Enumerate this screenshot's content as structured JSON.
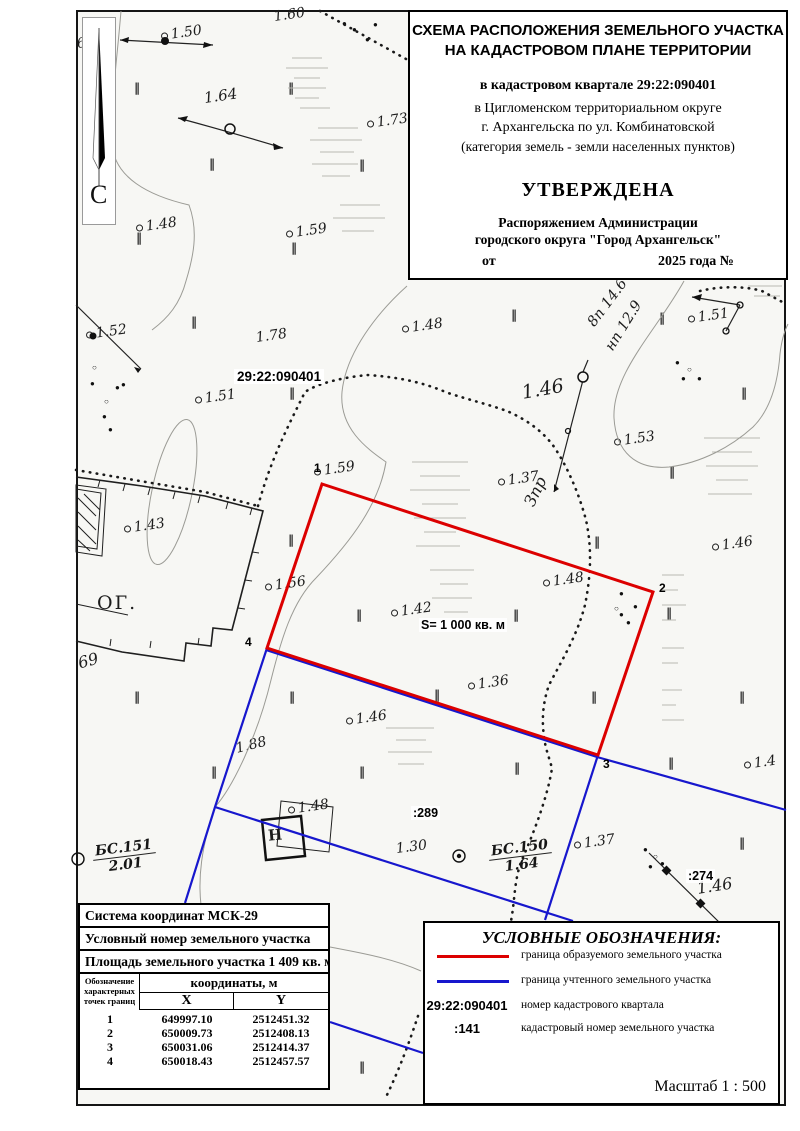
{
  "title_block": {
    "line1": "СХЕМА РАСПОЛОЖЕНИЯ ЗЕМЕЛЬНОГО УЧАСТКА",
    "line2": "НА КАДАСТРОВОМ ПЛАНЕ ТЕРРИТОРИИ",
    "quarter": "в кадастровом квартале 29:22:090401",
    "district1": "в Цигломенском территориальном округе",
    "district2": "г. Архангельска по ул. Комбинатовской",
    "category": "(категория земель - земли населенных пунктов)",
    "approved": "УТВЕРЖДЕНА",
    "order1": "Распоряжением Администрации",
    "order2": "городского округа \"Город Архангельск\"",
    "date_from": "от",
    "date_year": "2025 года №"
  },
  "north_label": "С",
  "map": {
    "quarter_label": "29:22:090401",
    "area_label": "S= 1 000 кв. м",
    "parcel_289": ":289",
    "parcel_274": ":274",
    "og_label": "ОГ.",
    "label_69": "69",
    "zpr_label": "Зпр",
    "line8p": "8п 14.6",
    "line_np": "нп 12.9",
    "bs150_top": "БС.150",
    "bs150_bottom": "1.64",
    "bs151_top": "БС.151",
    "bs151_bottom": "2.01",
    "building_label": "Н",
    "point_labels": [
      {
        "n": "1",
        "x": 314,
        "y": 461
      },
      {
        "n": "2",
        "x": 659,
        "y": 581
      },
      {
        "n": "3",
        "x": 603,
        "y": 757
      },
      {
        "n": "4",
        "x": 245,
        "y": 635
      }
    ],
    "red_parcel": [
      [
        322,
        484
      ],
      [
        653,
        592
      ],
      [
        598,
        755
      ],
      [
        267,
        648
      ]
    ],
    "blue_lines": [
      [
        [
          266,
          650
        ],
        [
          597,
          757
        ],
        [
          786,
          810
        ]
      ],
      [
        [
          267,
          648
        ],
        [
          215,
          807
        ],
        [
          185,
          903
        ]
      ],
      [
        [
          215,
          807
        ],
        [
          573,
          921
        ]
      ],
      [
        [
          598,
          755
        ],
        [
          545,
          920
        ]
      ],
      [
        [
          330,
          1022
        ],
        [
          423,
          1053
        ]
      ]
    ],
    "elevations": [
      {
        "t": "6",
        "x": 77,
        "y": 36,
        "c": false
      },
      {
        "t": "1.50",
        "x": 161,
        "y": 28,
        "c": true
      },
      {
        "t": "1.60",
        "x": 274,
        "y": 9,
        "c": false
      },
      {
        "t": "1.64",
        "x": 204,
        "y": 89,
        "c": false,
        "s": 15
      },
      {
        "t": "1.73",
        "x": 367,
        "y": 116,
        "c": true
      },
      {
        "t": "1.48",
        "x": 136,
        "y": 220,
        "c": true
      },
      {
        "t": "1.59",
        "x": 286,
        "y": 226,
        "c": true
      },
      {
        "t": "1.52",
        "x": 86,
        "y": 327,
        "c": true
      },
      {
        "t": "1.78",
        "x": 256,
        "y": 330,
        "c": false
      },
      {
        "t": "1.51",
        "x": 195,
        "y": 392,
        "c": true
      },
      {
        "t": "1.48",
        "x": 402,
        "y": 321,
        "c": true
      },
      {
        "t": "1.46",
        "x": 522,
        "y": 382,
        "c": false,
        "s": 19,
        "r": -10
      },
      {
        "t": "1.51",
        "x": 688,
        "y": 311,
        "c": true
      },
      {
        "t": "1.53",
        "x": 614,
        "y": 434,
        "c": true
      },
      {
        "t": "1.37",
        "x": 498,
        "y": 474,
        "c": true
      },
      {
        "t": "1.59",
        "x": 314,
        "y": 464,
        "c": true
      },
      {
        "t": "1.43",
        "x": 124,
        "y": 521,
        "c": true
      },
      {
        "t": "1.56",
        "x": 265,
        "y": 579,
        "c": true
      },
      {
        "t": "1.48",
        "x": 543,
        "y": 575,
        "c": true
      },
      {
        "t": "1.42",
        "x": 391,
        "y": 605,
        "c": true
      },
      {
        "t": "1.36",
        "x": 468,
        "y": 678,
        "c": true
      },
      {
        "t": "1.46",
        "x": 346,
        "y": 713,
        "c": true
      },
      {
        "t": "1.88",
        "x": 236,
        "y": 741,
        "c": false,
        "r": -14
      },
      {
        "t": "1.48",
        "x": 288,
        "y": 802,
        "c": true
      },
      {
        "t": "1.46",
        "x": 712,
        "y": 539,
        "c": true
      },
      {
        "t": "1.4",
        "x": 744,
        "y": 757,
        "c": true
      },
      {
        "t": "1.46",
        "x": 697,
        "y": 879,
        "c": false,
        "s": 16,
        "r": -9
      },
      {
        "t": "1.37",
        "x": 574,
        "y": 837,
        "c": true
      },
      {
        "t": "1.30",
        "x": 396,
        "y": 841,
        "c": false,
        "r": -7
      }
    ],
    "veg_marks": [
      [
        138,
        88
      ],
      [
        292,
        88
      ],
      [
        213,
        164
      ],
      [
        363,
        165
      ],
      [
        140,
        238
      ],
      [
        295,
        248
      ],
      [
        195,
        322
      ],
      [
        293,
        393
      ],
      [
        515,
        315
      ],
      [
        663,
        318
      ],
      [
        745,
        393
      ],
      [
        673,
        472
      ],
      [
        292,
        540
      ],
      [
        598,
        542
      ],
      [
        360,
        615
      ],
      [
        517,
        615
      ],
      [
        670,
        613
      ],
      [
        293,
        697
      ],
      [
        438,
        695
      ],
      [
        595,
        697
      ],
      [
        363,
        772
      ],
      [
        518,
        768
      ],
      [
        743,
        697
      ],
      [
        672,
        763
      ],
      [
        743,
        843
      ],
      [
        138,
        697
      ],
      [
        215,
        772
      ],
      [
        363,
        1067
      ]
    ],
    "dots": [
      [
        95,
        367,
        1
      ],
      [
        93,
        383,
        0
      ],
      [
        118,
        387,
        0
      ],
      [
        124,
        384,
        0
      ],
      [
        107,
        401,
        1
      ],
      [
        105,
        416,
        0
      ],
      [
        111,
        429,
        0
      ],
      [
        617,
        608,
        1
      ],
      [
        622,
        593,
        0
      ],
      [
        636,
        606,
        0
      ],
      [
        622,
        614,
        0
      ],
      [
        629,
        622,
        0
      ],
      [
        678,
        362,
        0
      ],
      [
        690,
        369,
        1
      ],
      [
        700,
        378,
        0
      ],
      [
        684,
        378,
        0
      ],
      [
        646,
        849,
        0
      ],
      [
        656,
        856,
        1
      ],
      [
        663,
        863,
        0
      ],
      [
        651,
        866,
        0
      ],
      [
        668,
        871,
        0
      ],
      [
        345,
        23,
        0
      ],
      [
        355,
        29,
        0
      ],
      [
        368,
        39,
        0
      ],
      [
        376,
        24,
        0
      ]
    ]
  },
  "table": {
    "row1": "Система координат МСК-29",
    "row2": "Условный номер земельного участка",
    "row3": "Площадь земельного участка 1 409 кв. м",
    "col_header": "Обозначение характерных точек границ",
    "coords_header": "координаты, м",
    "x_header": "X",
    "y_header": "Y",
    "rows": [
      [
        "1",
        "649997.10",
        "2512451.32"
      ],
      [
        "2",
        "650009.73",
        "2512408.13"
      ],
      [
        "3",
        "650031.06",
        "2512414.37"
      ],
      [
        "4",
        "650018.43",
        "2512457.57"
      ]
    ]
  },
  "legend": {
    "title": "УСЛОВНЫЕ ОБОЗНАЧЕНИЯ:",
    "items": [
      {
        "label": "граница образуемого земельного участка"
      },
      {
        "label": "граница учтенного земельного участка"
      },
      {
        "key": "29:22:090401",
        "label": "номер кадастрового квартала"
      },
      {
        "key": ":141",
        "label": "кадастровый номер земельного участка"
      }
    ],
    "scale_label": "Масштаб  1 : 500"
  },
  "colors": {
    "red": "#dc0000",
    "blue": "#1717cd"
  }
}
